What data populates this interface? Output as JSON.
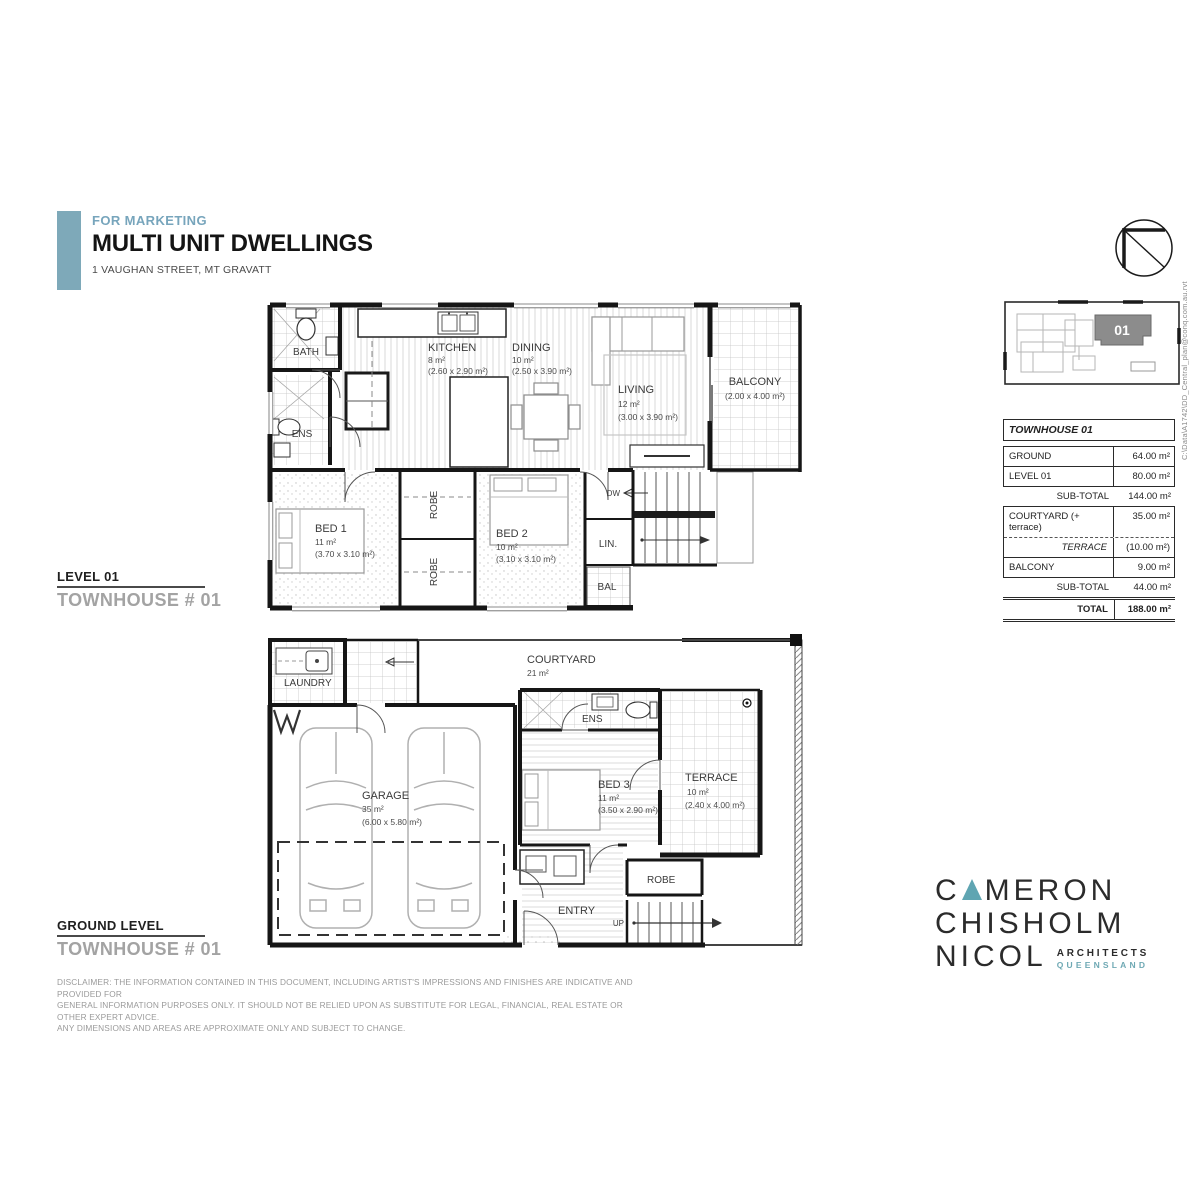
{
  "header": {
    "eyebrow": "FOR MARKETING",
    "title": "MULTI UNIT DWELLINGS",
    "address": "1 VAUGHAN STREET, MT GRAVATT"
  },
  "file_ref": "C:\\Data\\A1742\\DD_Central_plan@conq.com.au.rvt",
  "key_plan": {
    "unit": "01"
  },
  "area_table": {
    "title": "TOWNHOUSE 01",
    "rows": [
      {
        "label": "GROUND",
        "value": "64.00 m²"
      },
      {
        "label": "LEVEL 01",
        "value": "80.00 m²"
      },
      {
        "label": "SUB-TOTAL",
        "value": "144.00 m²"
      },
      {
        "label": "COURTYARD (+ terrace)",
        "value": "35.00 m²"
      },
      {
        "label": "TERRACE",
        "value": "(10.00 m²)"
      },
      {
        "label": "BALCONY",
        "value": "9.00 m²"
      },
      {
        "label": "SUB-TOTAL",
        "value": "44.00 m²"
      },
      {
        "label": "TOTAL",
        "value": "188.00 m²"
      }
    ]
  },
  "level01_caption": {
    "title": "LEVEL 01",
    "subtitle": "TOWNHOUSE # 01"
  },
  "ground_caption": {
    "title": "GROUND LEVEL",
    "subtitle": "TOWNHOUSE # 01"
  },
  "level01": {
    "bath": "BATH",
    "ens": "ENS",
    "kitchen": {
      "name": "KITCHEN",
      "area": "8 m²",
      "dims": "(2.60 x 2.90 m²)"
    },
    "dining": {
      "name": "DINING",
      "area": "10 m²",
      "dims": "(2.50 x 3.90 m²)"
    },
    "living": {
      "name": "LIVING",
      "area": "12 m²",
      "dims": "(3.00 x 3.90 m²)"
    },
    "balcony": {
      "name": "BALCONY",
      "dims": "(2.00 x 4.00 m²)"
    },
    "bed1": {
      "name": "BED 1",
      "area": "11 m²",
      "dims": "(3.70 x 3.10 m²)"
    },
    "bed2": {
      "name": "BED 2",
      "area": "10 m²",
      "dims": "(3.10 x 3.10 m²)"
    },
    "robe_a": "ROBE",
    "robe_b": "ROBE",
    "lin": "LIN.",
    "bal": "BAL",
    "dw": "DW"
  },
  "ground": {
    "laundry": "LAUNDRY",
    "courtyard": {
      "name": "COURTYARD",
      "area": "21 m²"
    },
    "ens": "ENS",
    "bed3": {
      "name": "BED 3",
      "area": "11 m²",
      "dims": "(3.50 x 2.90 m²)"
    },
    "terrace": {
      "name": "TERRACE",
      "area": "10 m²",
      "dims": "(2.40 x 4.00 m²)"
    },
    "garage": {
      "name": "GARAGE",
      "area": "35 m²",
      "dims": "(6.00 x 5.80 m²)"
    },
    "robe": "ROBE",
    "entry": "ENTRY",
    "up": "UP"
  },
  "disclaimer": {
    "line1": "DISCLAIMER: THE INFORMATION CONTAINED IN THIS DOCUMENT, INCLUDING ARTIST'S IMPRESSIONS AND FINISHES ARE INDICATIVE AND PROVIDED FOR",
    "line2": "GENERAL INFORMATION PURPOSES ONLY. IT SHOULD NOT BE RELIED UPON AS SUBSTITUTE FOR LEGAL, FINANCIAL, REAL ESTATE OR OTHER EXPERT ADVICE.",
    "line3": "ANY DIMENSIONS AND AREAS ARE APPROXIMATE ONLY AND SUBJECT TO CHANGE."
  },
  "logo": {
    "word1_pre": "C",
    "word1_post": "MERON",
    "word2": "CHISHOLM",
    "word3": "NICOL",
    "tag1": "ARCHITECTS",
    "tag2": "QUEENSLAND"
  },
  "colors": {
    "accent": "#7ea9b9",
    "logo_teal": "#5fa5b2"
  }
}
